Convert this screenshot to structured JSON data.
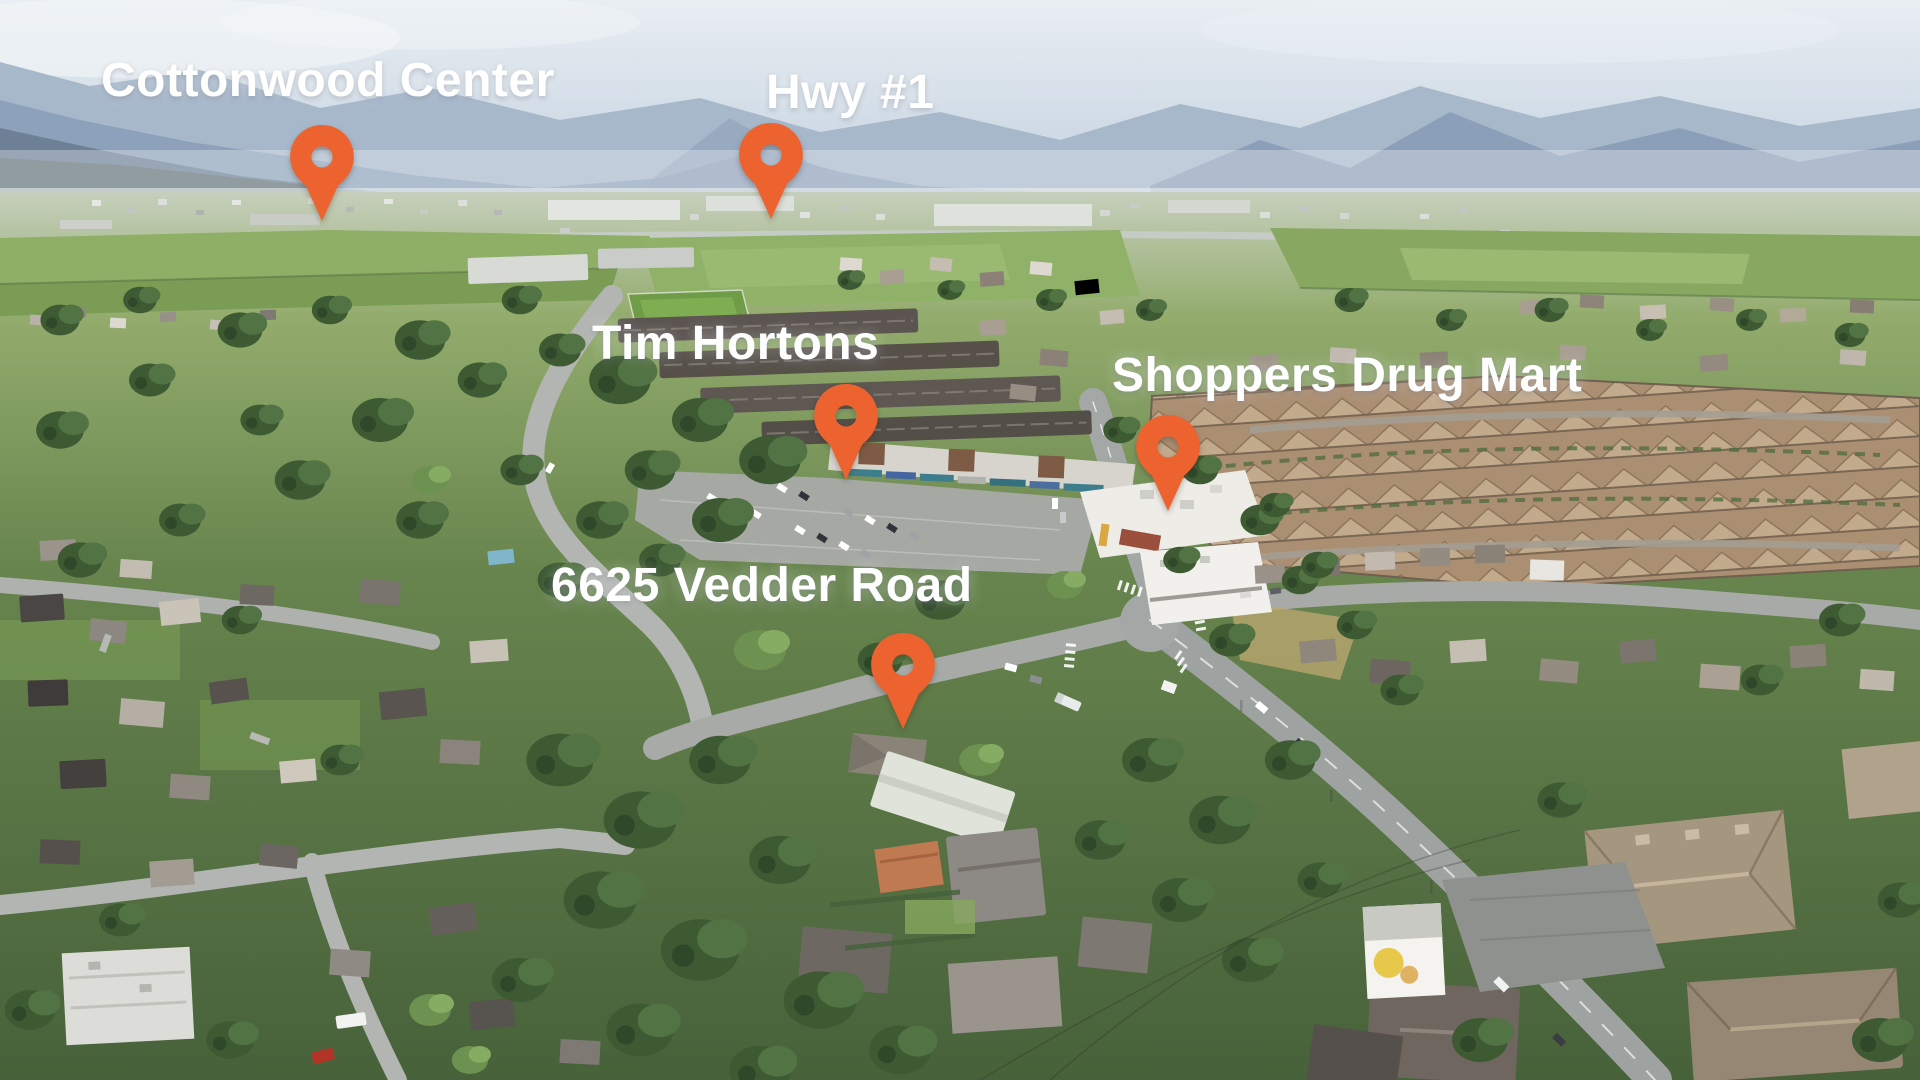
{
  "annotations": [
    {
      "id": "cottonwood-center",
      "label": "Cottonwood Center"
    },
    {
      "id": "hwy-1",
      "label": "Hwy #1"
    },
    {
      "id": "tim-hortons",
      "label": "Tim Hortons"
    },
    {
      "id": "shoppers-drug-mart",
      "label": "Shoppers Drug Mart"
    },
    {
      "id": "property-6625-vedder-road",
      "label": "6625 Vedder Road"
    }
  ],
  "pin": {
    "color": "#ec6330",
    "icon": "map-pin"
  },
  "scene": {
    "type": "aerial-photo",
    "colors": {
      "sky": "#dce5ee",
      "mountains": "#8ba0b8",
      "haze": "#eef2f5",
      "farmland": "#8fae66",
      "forest": "#3d5a33",
      "roads": "#a3a7a5",
      "townhouse_roofs": "#b99f82",
      "dark_roofs": "#5b5450",
      "shoppers_roof": "#edece7",
      "shoppers_accent": "#9a4f3d",
      "parking": "#a6a8a4",
      "label_text": "#ffffff"
    }
  }
}
